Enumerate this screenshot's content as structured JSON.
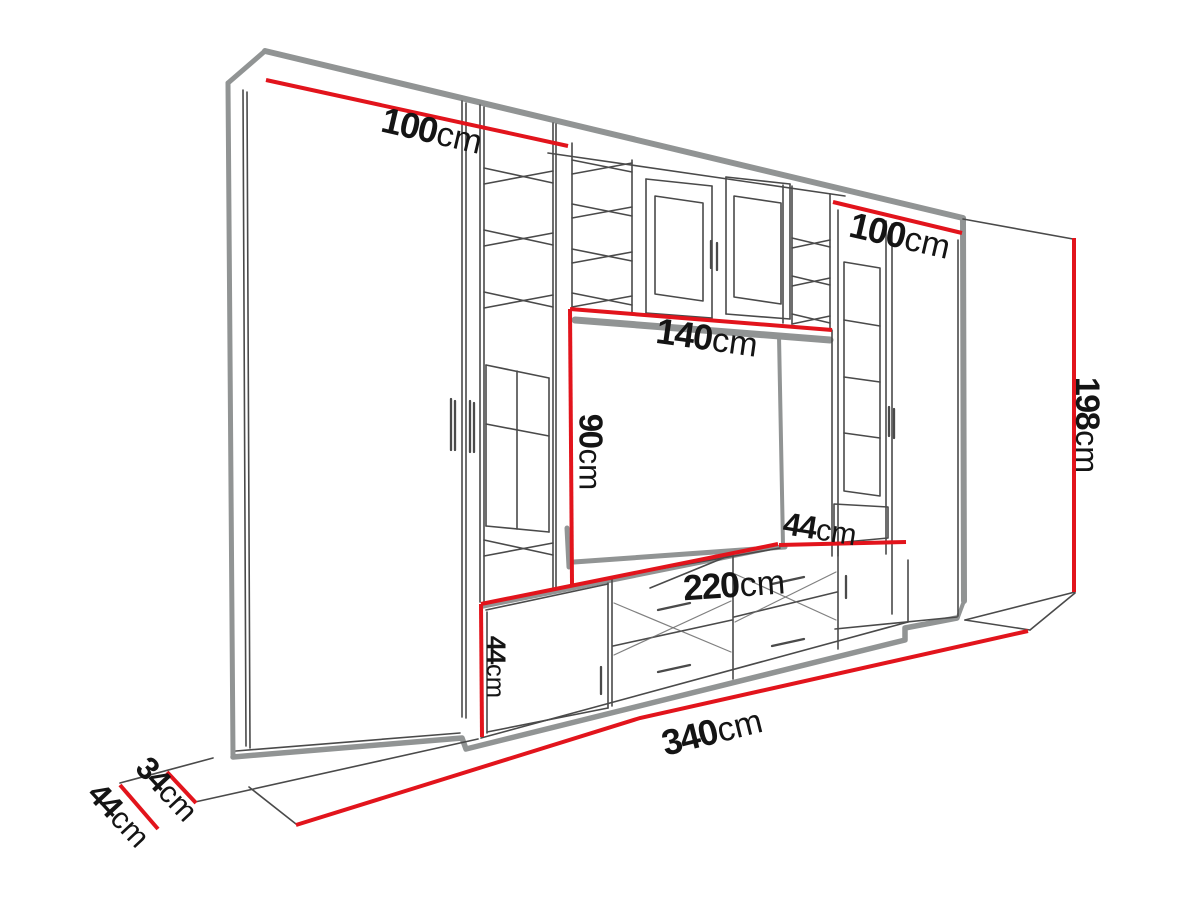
{
  "meta": {
    "description": "Perspective dimension diagram of a TV entertainment wall unit",
    "unit_system": "cm"
  },
  "colors": {
    "dimension_red": "#e2141c",
    "outline_gray": "#919494",
    "sketch_line": "#4a4a4a",
    "label_text": "#141414",
    "background": "#ffffff"
  },
  "dimensions": {
    "left_upper_width": {
      "value": "100",
      "unit": "cm"
    },
    "right_upper_width": {
      "value": "100",
      "unit": "cm"
    },
    "niche_width": {
      "value": "140",
      "unit": "cm"
    },
    "niche_height": {
      "value": "90",
      "unit": "cm"
    },
    "base_top_depth": {
      "value": "44",
      "unit": "cm"
    },
    "base_width": {
      "value": "220",
      "unit": "cm"
    },
    "base_height": {
      "value": "44",
      "unit": "cm"
    },
    "total_width": {
      "value": "340",
      "unit": "cm"
    },
    "total_height": {
      "value": "198",
      "unit": "cm"
    },
    "upper_depth": {
      "value": "34",
      "unit": "cm"
    },
    "base_depth": {
      "value": "44",
      "unit": "cm"
    }
  }
}
